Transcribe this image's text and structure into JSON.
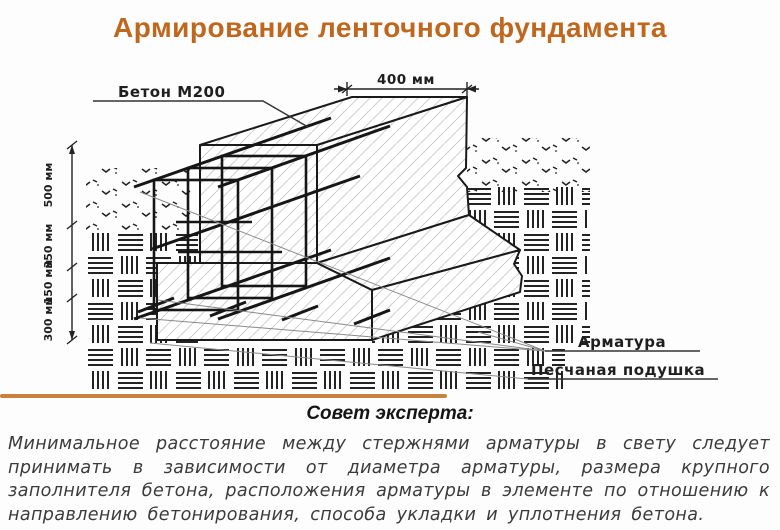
{
  "title": "Армирование ленточного фундамента",
  "diagram": {
    "labels": {
      "concrete": "Бетон М200",
      "rebar": "Арматура",
      "sand_cushion": "Песчаная подушка"
    },
    "dimensions": {
      "top_width": "400 мм",
      "left": [
        "500 мм",
        "350 мм",
        "150 мм",
        "300 мм"
      ]
    }
  },
  "advice": {
    "heading": "Совет эксперта:",
    "lines": [
      "Минимальное расстояние между стержнями арматуры в свету следует",
      "принимать в зависимости от диаметра арматуры, размера крупного",
      "заполнителя бетона, расположения арматуры в элементе по отношению к",
      "направлению бетонирования, способа укладки и уплотнения бетона."
    ]
  },
  "colors": {
    "title": "#bf671c",
    "divider": "#c8823d",
    "drawing_line": "#1a1a1a",
    "soil_hatch": "#232323",
    "concrete_hatch": "#cfcfcf",
    "label_text": "#1f1f1f",
    "body_text": "#3b3b3b"
  }
}
